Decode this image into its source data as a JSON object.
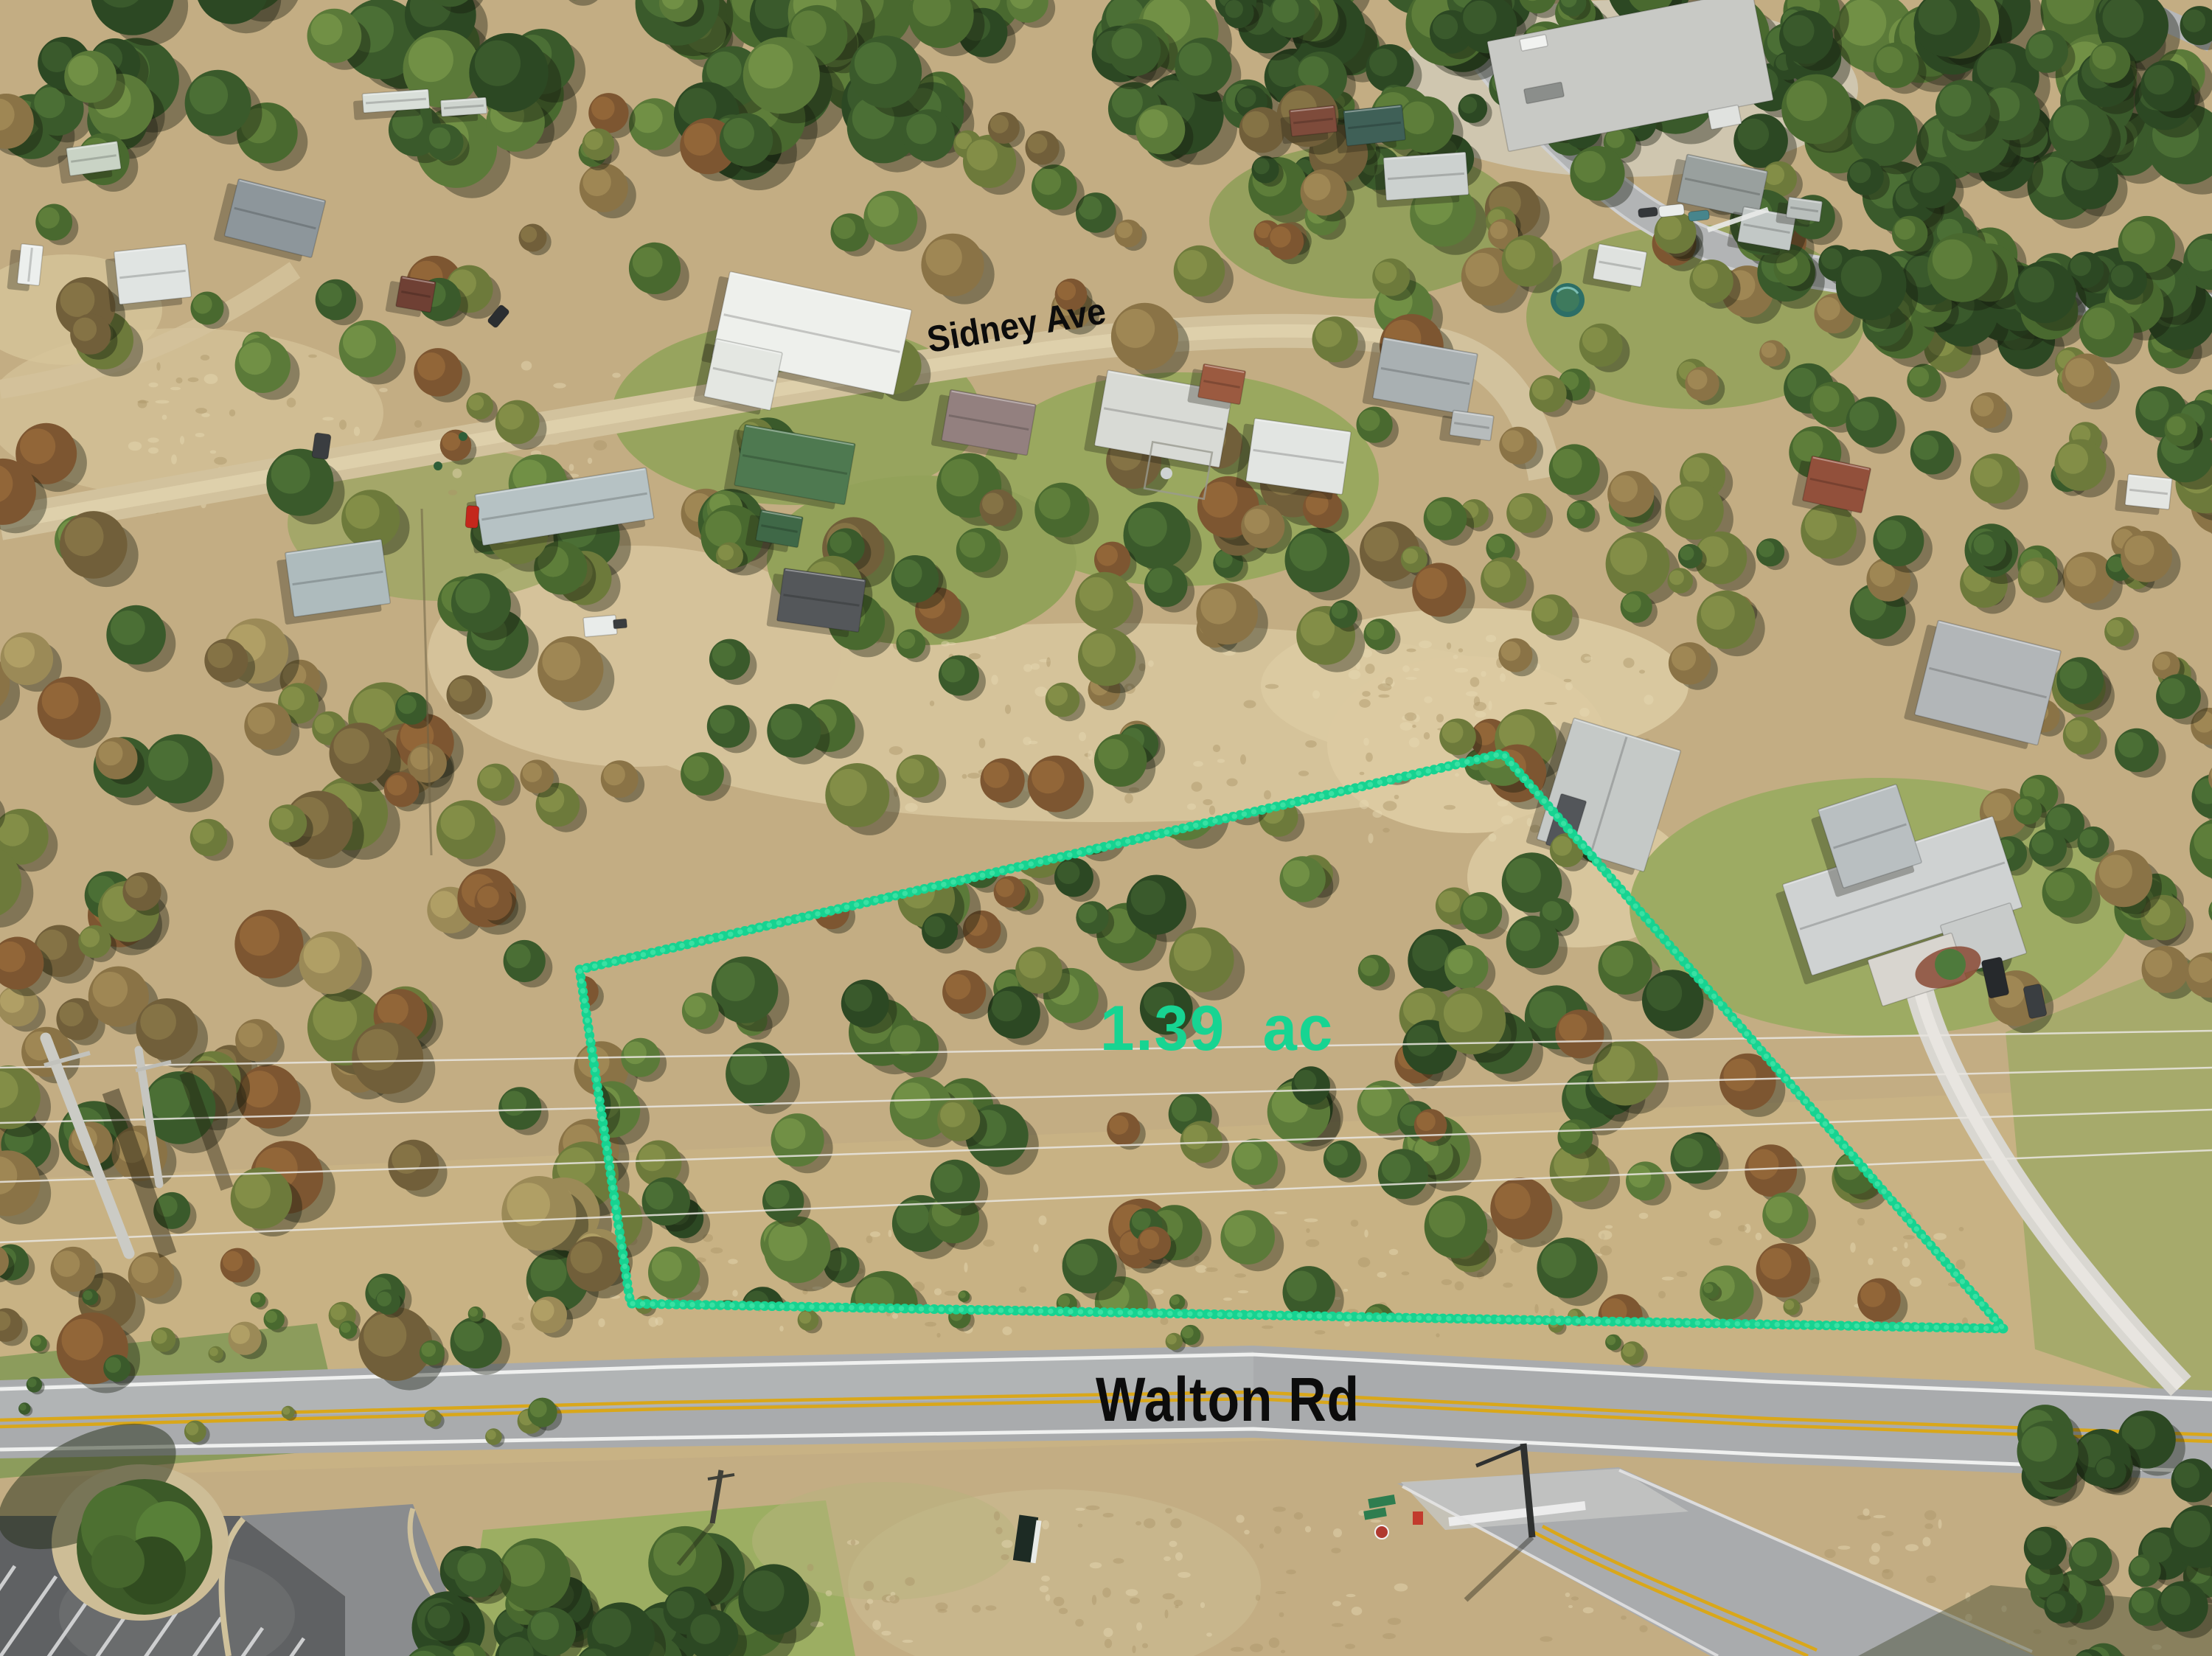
{
  "scene": {
    "description": "Aerial drone photo of a wooded vacant lot for sale, boundary outlined in green between two streets"
  },
  "annotations": {
    "street_label_top": "Sidney Ave",
    "street_label_bottom": "Walton Rd",
    "lot_area_label": "1.39 ac",
    "boundary_polygon_points": "786,1315 2038,1022 2717,1802 855,1768",
    "colors": {
      "boundary_green": "#17d391",
      "area_label_green": "#17d492",
      "street_label_black": "#0c0c0c"
    }
  }
}
